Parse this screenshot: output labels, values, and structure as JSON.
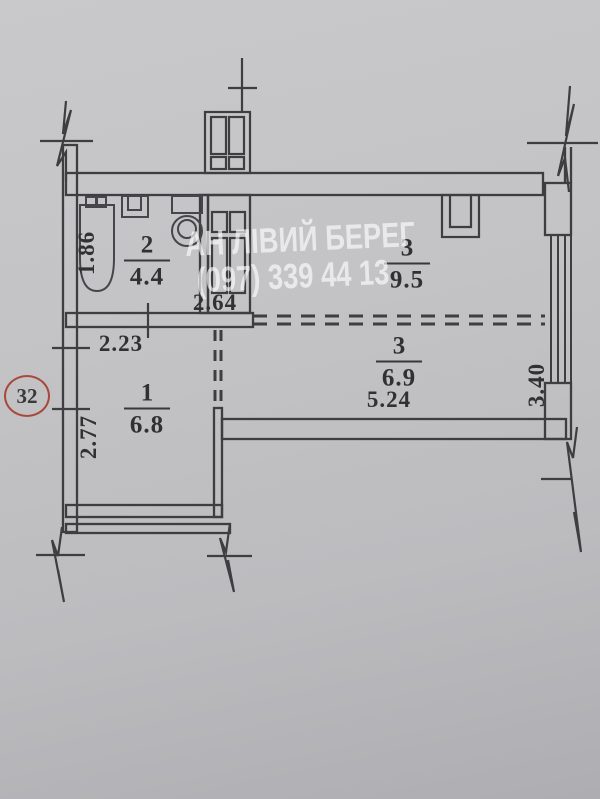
{
  "document_type": "apartment floor plan scan",
  "watermark": {
    "agency_name": "АН ЛІВИЙ БЕРЕГ",
    "phone": "(097) 339 44 13"
  },
  "unit_number": "32",
  "rooms": {
    "bathroom": {
      "number": "2",
      "area": "4.4"
    },
    "living_upper": {
      "number": "3",
      "area": "9.5"
    },
    "living_lower": {
      "number": "3",
      "area": "6.9"
    },
    "hall": {
      "number": "1",
      "area": "6.8"
    }
  },
  "dimensions": {
    "bathtub_length": "1.86",
    "bathroom_width": "2.64",
    "hall_width": "2.23",
    "hall_depth": "2.77",
    "living_width": "5.24",
    "living_depth": "3.40"
  },
  "colors": {
    "paper": "#c2c2c4",
    "ink": "#3e3e41",
    "badge_ring": "#a8493c",
    "watermark": "rgba(255,255,255,0.63)"
  }
}
